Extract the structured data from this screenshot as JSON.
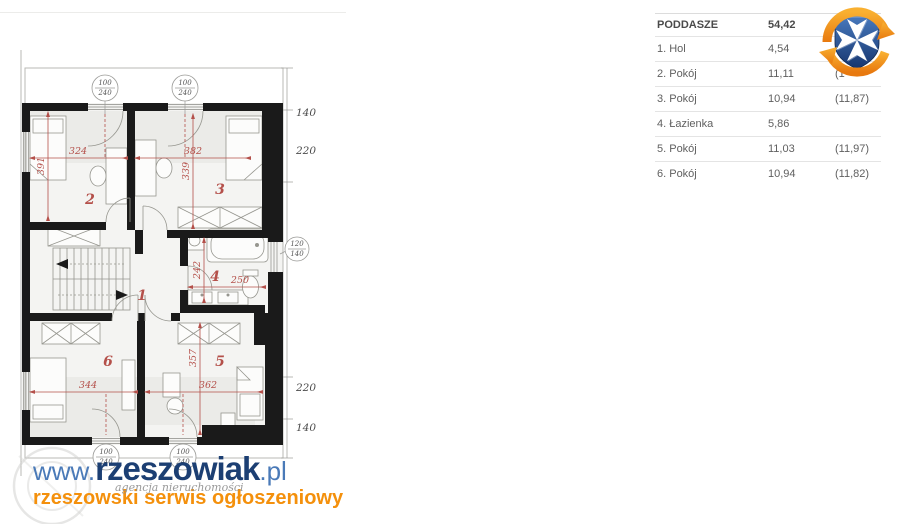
{
  "plan": {
    "room_numbers": {
      "r1": "1",
      "r2": "2",
      "r3": "3",
      "r4": "4",
      "r5": "5",
      "r6": "6"
    },
    "dims": {
      "d324": "324",
      "d382": "382",
      "d391": "391",
      "d339": "339",
      "d242": "242",
      "d250": "250",
      "d357": "357",
      "d344": "344",
      "d362": "362"
    },
    "side_dims": {
      "top_140": "140",
      "top_220": "220",
      "bottom_220": "220",
      "bottom_140": "140"
    },
    "window_marker": {
      "top": "100",
      "bottom": "240"
    },
    "door_marker": {
      "top": "120",
      "bottom": "140"
    }
  },
  "table": {
    "header": {
      "label": "PODDASZE",
      "value": "54,42"
    },
    "rows": [
      {
        "label": "1. Hol",
        "value": "4,54",
        "extra": ""
      },
      {
        "label": "2. Pokój",
        "value": "11,11",
        "extra": "(1"
      },
      {
        "label": "3. Pokój",
        "value": "10,94",
        "extra": "(11,87)"
      },
      {
        "label": "4. Łazienka",
        "value": "5,86",
        "extra": ""
      },
      {
        "label": "5. Pokój",
        "value": "11,03",
        "extra": "(11,97)"
      },
      {
        "label": "6. Pokój",
        "value": "10,94",
        "extra": "(11,82)"
      }
    ]
  },
  "watermark": {
    "prefix": "www.",
    "name": "rzeszowiak",
    "suffix": ".pl",
    "agency": "agencja nieruchomości",
    "tagline": "rzeszowski serwis ogłoszeniowy"
  },
  "colors": {
    "plan_red": "#b4504a",
    "wall": "#1a1a1a",
    "watermark_navy": "#1c3f73",
    "watermark_blue": "#4a7ab8",
    "watermark_orange": "#f4900c",
    "logo_blue": "#2b57a5",
    "logo_orange": "#f59c1b"
  }
}
